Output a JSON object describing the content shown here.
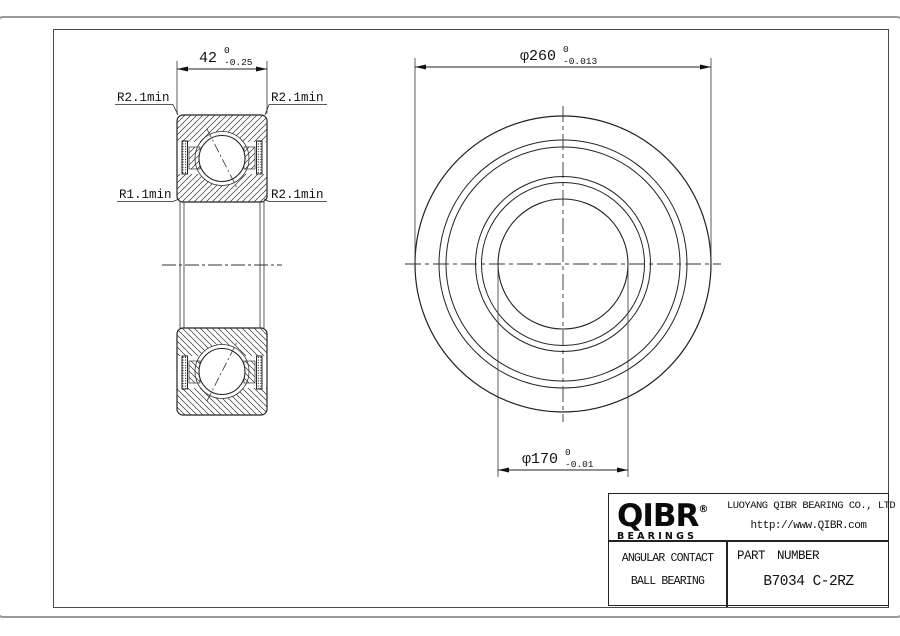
{
  "annotations": {
    "width_dim": {
      "text": "42",
      "tol_top": "0",
      "tol_bottom": "-0.25"
    },
    "outer_dia": {
      "text": "φ260",
      "tol_top": "0",
      "tol_bottom": "-0.013"
    },
    "bore_dia": {
      "text": "φ170",
      "tol_top": "0",
      "tol_bottom": "-0.01"
    },
    "radius_top_left": "R2.1min",
    "radius_top_right": "R2.1min",
    "radius_bottom_left": "R1.1min",
    "radius_bottom_right": "R2.1min"
  },
  "title_block": {
    "brand": "QIBR",
    "registered_mark": "®",
    "brand_sub": "BEARINGS",
    "company": "LUOYANG QIBR BEARING CO., LTD",
    "website": "http://www.QIBR.com",
    "product_line1": "ANGULAR CONTACT",
    "product_line2": "BALL BEARING",
    "part_number_label": "PART NUMBER",
    "part_number": "B7034 C-2RZ"
  },
  "colors": {
    "line": "#222222",
    "thin_line": "#333333",
    "frame": "#4a4a4a",
    "sheet_border": "#9a9a9a"
  }
}
